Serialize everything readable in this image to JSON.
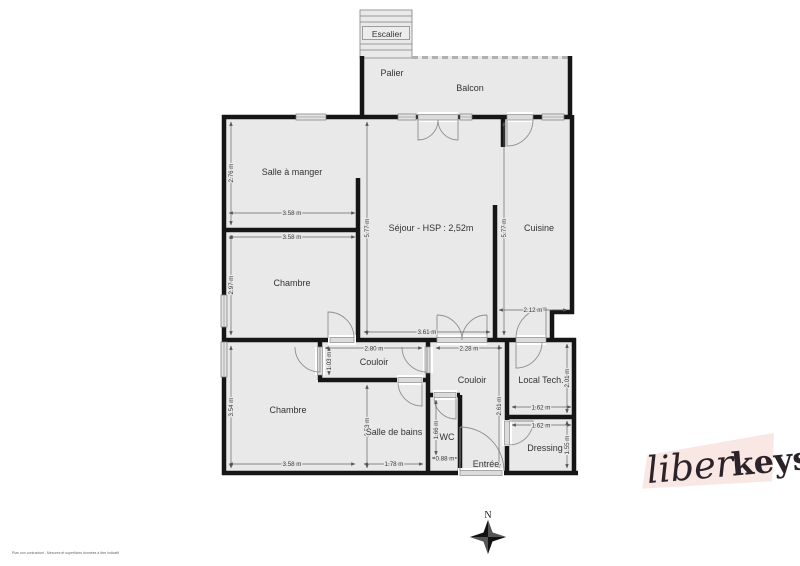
{
  "plan": {
    "rooms": [
      {
        "id": "escalier",
        "label": "Escalier"
      },
      {
        "id": "palier",
        "label": "Palier"
      },
      {
        "id": "balcon",
        "label": "Balcon"
      },
      {
        "id": "salle-a-manger",
        "label": "Salle à manger"
      },
      {
        "id": "sejour",
        "label": "Séjour - HSP : 2,52m"
      },
      {
        "id": "cuisine",
        "label": "Cuisine"
      },
      {
        "id": "chambre-1",
        "label": "Chambre"
      },
      {
        "id": "couloir-1",
        "label": "Couloir"
      },
      {
        "id": "chambre-2",
        "label": "Chambre"
      },
      {
        "id": "salle-de-bains",
        "label": "Salle de bains"
      },
      {
        "id": "wc",
        "label": "WC"
      },
      {
        "id": "couloir-2",
        "label": "Couloir"
      },
      {
        "id": "entree",
        "label": "Entrée"
      },
      {
        "id": "local-tech",
        "label": "Local Tech."
      },
      {
        "id": "dressing",
        "label": "Dressing"
      }
    ],
    "dims": {
      "szm_w": "3.58 m",
      "szm_h": "2.76 m",
      "chambre1_w": "3.58 m",
      "chambre1_h": "2.97 m",
      "chambre2_w": "3.58 m",
      "chambre2_h": "3.54 m",
      "sejour_w": "3.61 m",
      "sejour_h": "5.77 m",
      "cuisine_w": "2.12 m",
      "cuisine_h": "5.77 m",
      "couloir1_w": "2.80 m",
      "couloir1_h": "1.03 m",
      "couloir2_w": "2.28 m",
      "couloir2_h": "2.61 m",
      "sdb_w": "1.78 m",
      "sdb_h": "2.53 m",
      "wc_w": "0.88 m",
      "wc_h": "1.66 m",
      "localtech_w": "1.62 m",
      "localtech_h": "2.01 m",
      "dressing_w": "1.62 m",
      "dressing_h": "1.55 m"
    },
    "colors": {
      "room_fill": "#e9e9e9",
      "wall": "#161616",
      "logo_background": "#f8e7e2",
      "logo_text": "#2b2329"
    }
  },
  "compass": {
    "north": "N"
  },
  "logo": {
    "part1": "liber",
    "part2": "keys"
  },
  "footer": {
    "disclaimer": "Plan non contractuel - Mesures et superficies données à titre indicatif"
  }
}
